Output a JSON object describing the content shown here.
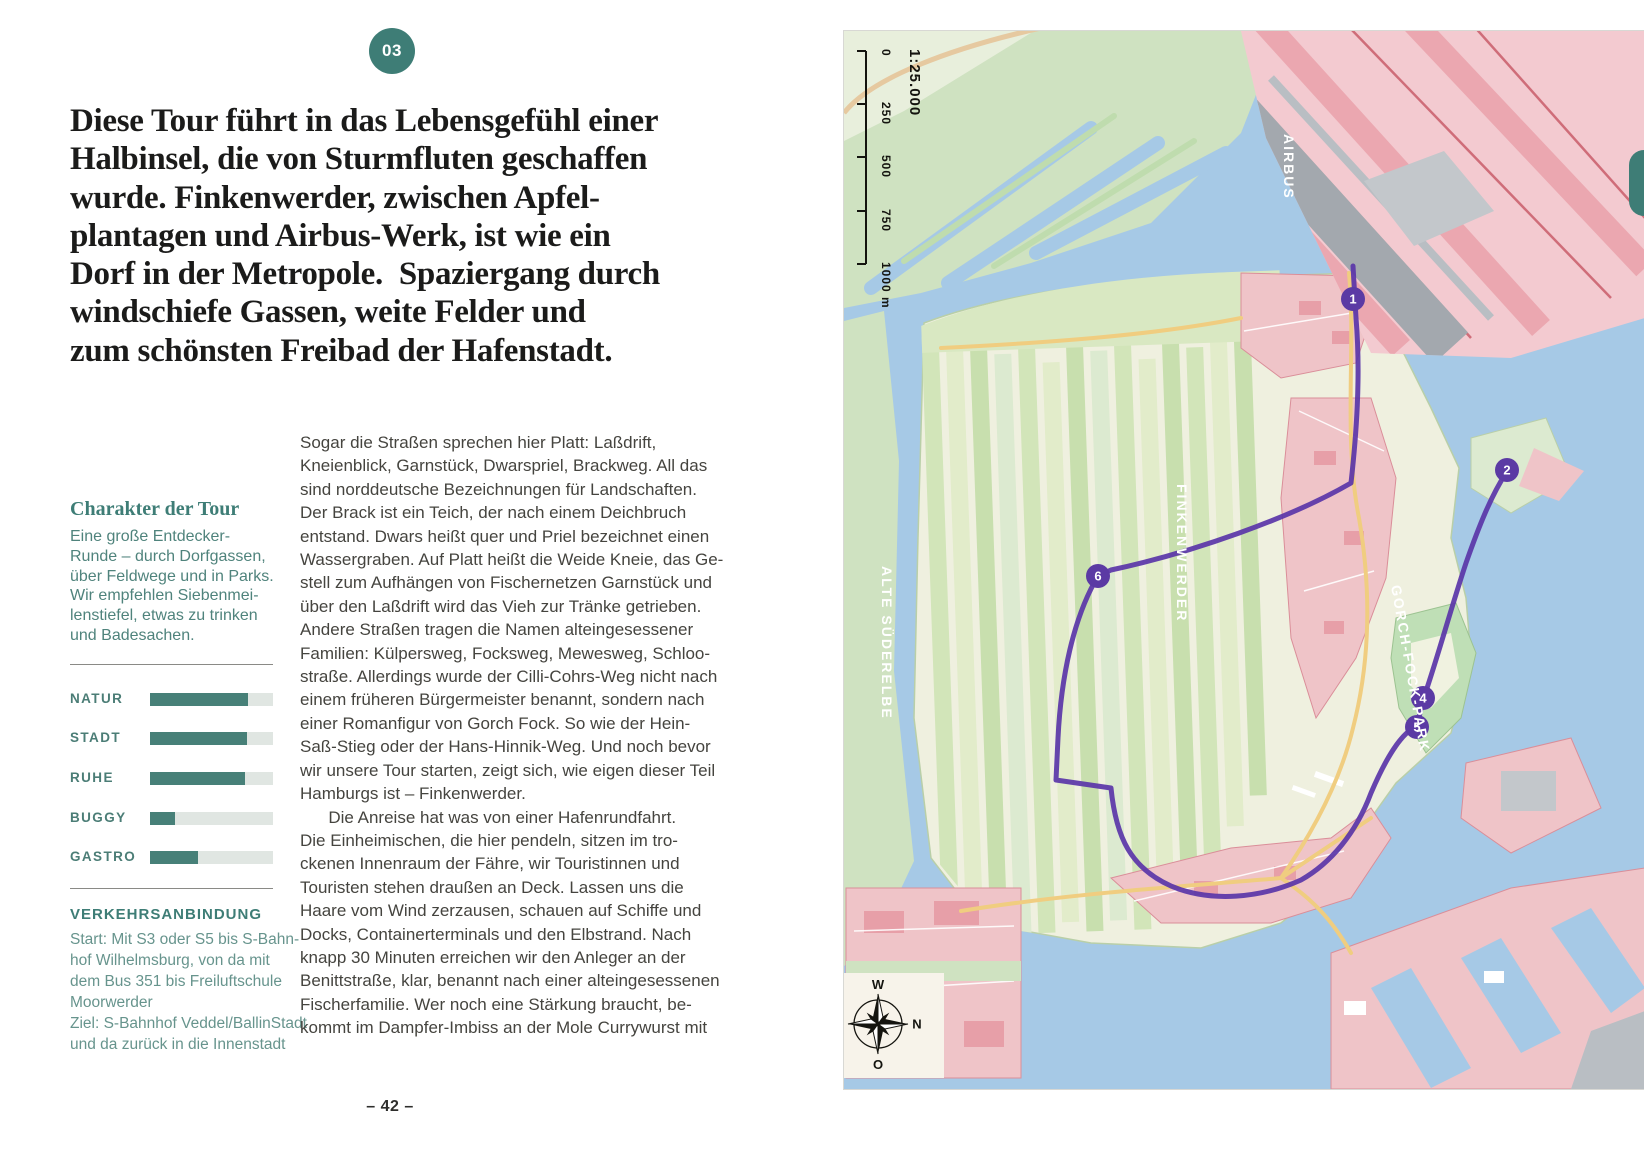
{
  "left": {
    "badge": "03",
    "headline_lines": [
      "Diese Tour führt in das Lebensgefühl einer",
      "Halbinsel, die von Sturmfluten geschaffen",
      "wurde. Finkenwerder, zwischen Apfel-",
      "plantagen und Airbus-Werk, ist wie ein",
      "Dorf in der Metropole.  Spaziergang durch",
      "windschiefe Gassen, weite Felder und",
      "zum schönsten Freibad der Hafenstadt."
    ],
    "character_title": "Charakter der Tour",
    "character_lines": [
      "Eine große Entdecker-",
      "Runde – durch Dorfgassen,",
      "über Feldwege und in Parks.",
      "Wir empfehlen Siebenmei-",
      "lenstiefel, etwas zu trinken",
      "und Badesachen."
    ],
    "ratings": [
      {
        "label": "NATUR",
        "value": 0.8
      },
      {
        "label": "STADT",
        "value": 0.79
      },
      {
        "label": "RUHE",
        "value": 0.77
      },
      {
        "label": "BUGGY",
        "value": 0.2
      },
      {
        "label": "GASTRO",
        "value": 0.39
      }
    ],
    "transport_title": "VERKEHRSANBINDUNG",
    "transport_lines": [
      "Start: Mit S3 oder S5 bis S-Bahn-",
      "hof Wilhelmsburg, von da mit",
      "dem Bus 351 bis Freiluftschule",
      "Moorwerder",
      "Ziel: S-Bahnhof Veddel/BallinStadt",
      "und da zurück in die Innenstadt"
    ],
    "body_lines": [
      "Sogar die Straßen sprechen hier Platt: Laßdrift,",
      "Kneienblick, Garnstück, Dwarspriel, Brackweg. All das",
      "sind norddeutsche Bezeichnungen für Landschaften.",
      "Der Brack ist ein Teich, der nach einem Deichbruch",
      "entstand. Dwars heißt quer und Priel bezeichnet einen",
      "Wassergraben. Auf Platt heißt die Weide Kneie, das Ge-",
      "stell zum Aufhängen von Fischernetzen Garnstück und",
      "über den Laßdrift wird das Vieh zur Tränke getrieben.",
      "Andere Straßen tragen die Namen alteingesessener",
      "Familien: Külpersweg, Focksweg, Mewesweg, Schloo-",
      "straße. Allerdings wurde der Cilli-Cohrs-Weg nicht nach",
      "einem früheren Bürgermeister benannt, sondern nach",
      "einer Romanfigur von Gorch Fock. So wie der Hein-",
      "Saß-Stieg oder der Hans-Hinnik-Weg. Und noch bevor",
      "wir unsere Tour starten, zeigt sich, wie eigen dieser Teil",
      "Hamburgs ist – Finkenwerder.",
      "      Die Anreise hat was von einer Hafenrundfahrt.",
      "Die Einheimischen, die hier pendeln, sitzen im tro-",
      "ckenen Innenraum der Fähre, wir Touristinnen und",
      "Touristen stehen draußen an Deck. Lassen uns die",
      "Haare vom Wind zerzausen, schauen auf Schiffe und",
      "Docks, Containerterminals und den Elbstrand. Nach",
      "knapp 30 Minuten erreichen wir den Anleger an der",
      "Benittstraße, klar, benannt nach einer alteingesessenen",
      "Fischerfamilie. Wer noch eine Stärkung braucht, be-",
      "kommt im Dampfer-Imbiss an der Mole Currywurst mit"
    ],
    "page_number": "– 42 –"
  },
  "map": {
    "scale": {
      "ratio": "1:25.000",
      "ticks": [
        "0",
        "250",
        "500",
        "750",
        "1000 m"
      ]
    },
    "labels": {
      "airbus": "AIRBUS",
      "finkenwerder": "FINKENWERDER",
      "alte_suederelbe": "ALTE SÜDERELBE",
      "gorch_fock_park": "GORCH-FOCK-PARK"
    },
    "waypoints": [
      {
        "label": "1"
      },
      {
        "label": "2"
      },
      {
        "label": "4"
      },
      {
        "label": "5"
      },
      {
        "label": "6"
      }
    ],
    "compass": {
      "top": "W",
      "right": "N",
      "bottom": "O",
      "left": "S"
    },
    "colors": {
      "water": "#a6c9e6",
      "fields": "#d2e5b9",
      "urban_pink": "#efc4c8",
      "runway_gray": "#a3a8ae",
      "route_purple": "#5a35a8",
      "road_yellow": "#f0cd80",
      "accent_teal": "#3e7d76"
    }
  }
}
